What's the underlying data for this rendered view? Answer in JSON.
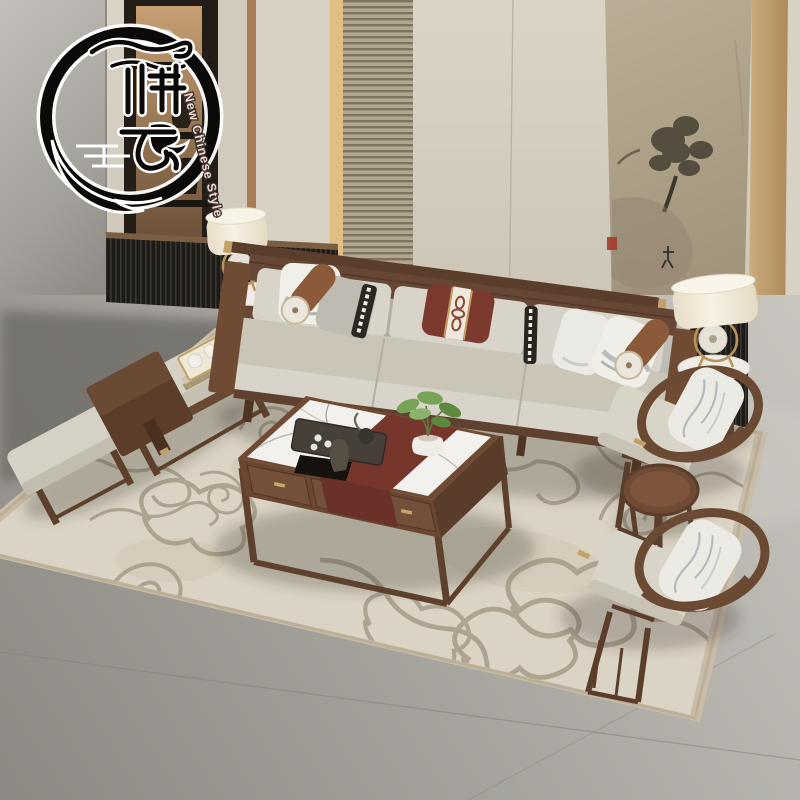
{
  "image": {
    "kind": "furniture product photograph",
    "room": "living room",
    "collection_style": "New Chinese Style walnut and beige living-room set, elevated three-quarter view"
  },
  "logo": {
    "brand_characters": "雅艺",
    "tagline": "New Chinese Style",
    "emblem": "black ink brush circle with cloud scrolls and calligraphy",
    "ink_color": "#0b0a09",
    "tagline_color": "#f2d6d1"
  },
  "objects": {
    "sofa": "three-seat walnut frame sofa with beige cushions, six throw pillows and two leather bolsters",
    "pillows": [
      "white landscape-print pillow",
      "grey pillow with black greek-key band",
      "maroon pillow with white chain-motif centre band",
      "grey pillow with black greek-key band",
      "plain white pillow",
      "white landscape-print pillow tilted on right arm"
    ],
    "coffee_table": "walnut coffee table with white marble top, maroon runner and three drawers with brass pulls",
    "coffee_table_decor": [
      "dark tea tray with teapot and white cups",
      "dark stone sculpture on black mat",
      "white vase with green plant"
    ],
    "armchairs": "two walnut horseshoe-back armchairs with beige seats and marble-print pillows",
    "round_tea_table": "small round walnut tea table between the armchairs",
    "bench": "walnut bench with beige cushion, dark waterfall side board and nesting stool",
    "bench_tray": "brass tray with white tea ceramics stacked on books",
    "side_tables": "two cylindrical walnut side tables with white marble tops",
    "lamps": "two cream drum table lamps with brass ring and jade disc ornament",
    "rug": "large beige rug with tonal cloud-scroll pattern and darker border",
    "wall": "cream panelled wall with wood strips, slatted panel, lit display niche and Chinese ink painting with red seal",
    "console": "low dark slatted console along the wall",
    "floor": "large grey tiles"
  },
  "palette": {
    "walnut": "#6f4b34",
    "fabric_beige": "#d6d1c6",
    "maroon": "#7b392e",
    "wall_cream": "#d6d0c3",
    "rug_beige": "#d9d1c2",
    "floor_grey": "#a7a49e",
    "brass": "#c0a269",
    "marble_white": "#f2f1ed",
    "plant_green": "#6f9c50",
    "painting_tan": "#b0a48b",
    "seal_red": "#a23c2a"
  }
}
